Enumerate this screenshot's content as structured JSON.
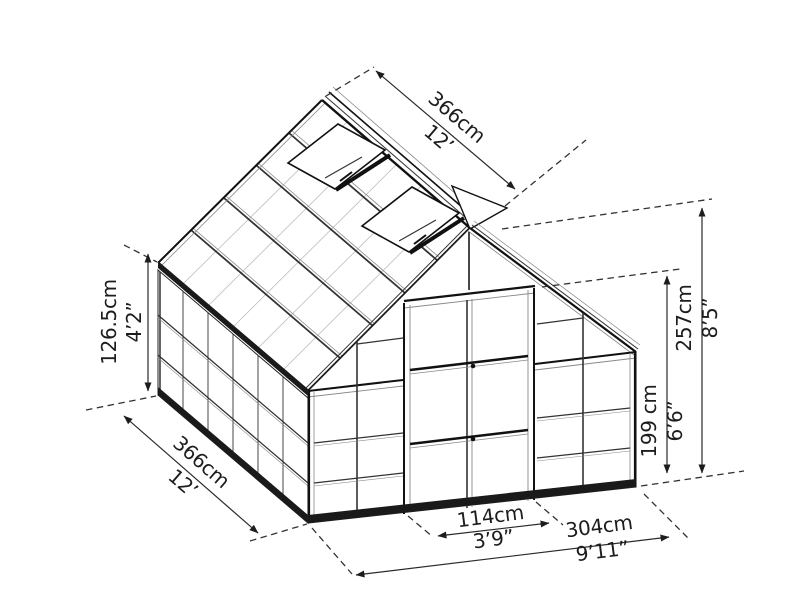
{
  "diagram": {
    "type": "greenhouse-dimension-drawing",
    "dimensions": {
      "ridge_length": {
        "cm": "366cm",
        "ft": "12’"
      },
      "side_length": {
        "cm": "366cm",
        "ft": "12’"
      },
      "wall_height": {
        "cm": "126.5cm",
        "ft": "4’2”"
      },
      "peak_height": {
        "cm": "257cm",
        "ft": "8’5”"
      },
      "door_height": {
        "cm": "199 cm",
        "ft": "6’6”"
      },
      "door_width": {
        "cm": "114cm",
        "ft": "3’9”"
      },
      "base_width": {
        "cm": "304cm",
        "ft": "9’11”"
      }
    },
    "line_color": "#1a1a1a",
    "background": "#ffffff"
  }
}
